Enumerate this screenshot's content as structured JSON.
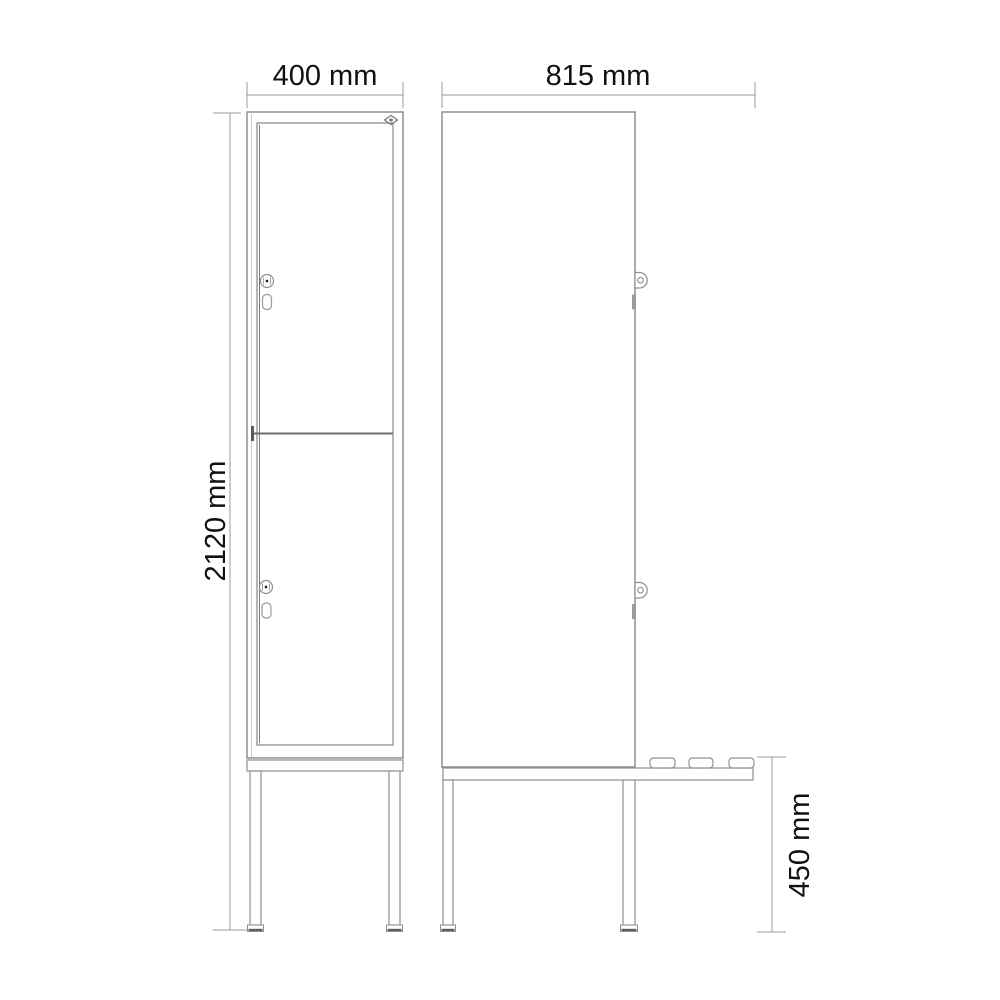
{
  "drawing": {
    "type": "technical-dimension-drawing",
    "subject": "two-door locker cabinet on bench stand, front view and side view",
    "dimensions": {
      "front_width": "400 mm",
      "side_depth": "815 mm",
      "overall_height": "2120 mm",
      "bench_height": "450 mm"
    },
    "colors": {
      "line": "#8f8f8f",
      "line_dark": "#6e6e6e",
      "dimension_line": "#9a9a9a",
      "text": "#111111",
      "background": "#ffffff"
    },
    "front_view": {
      "doors": 2,
      "icons": [
        "lock-icon",
        "handle-slot",
        "brand-diamond-icon"
      ]
    },
    "side_view": {
      "hinges": 2,
      "bench_slats": 3,
      "icons": [
        "hinge-icon",
        "bench-slat"
      ]
    }
  }
}
